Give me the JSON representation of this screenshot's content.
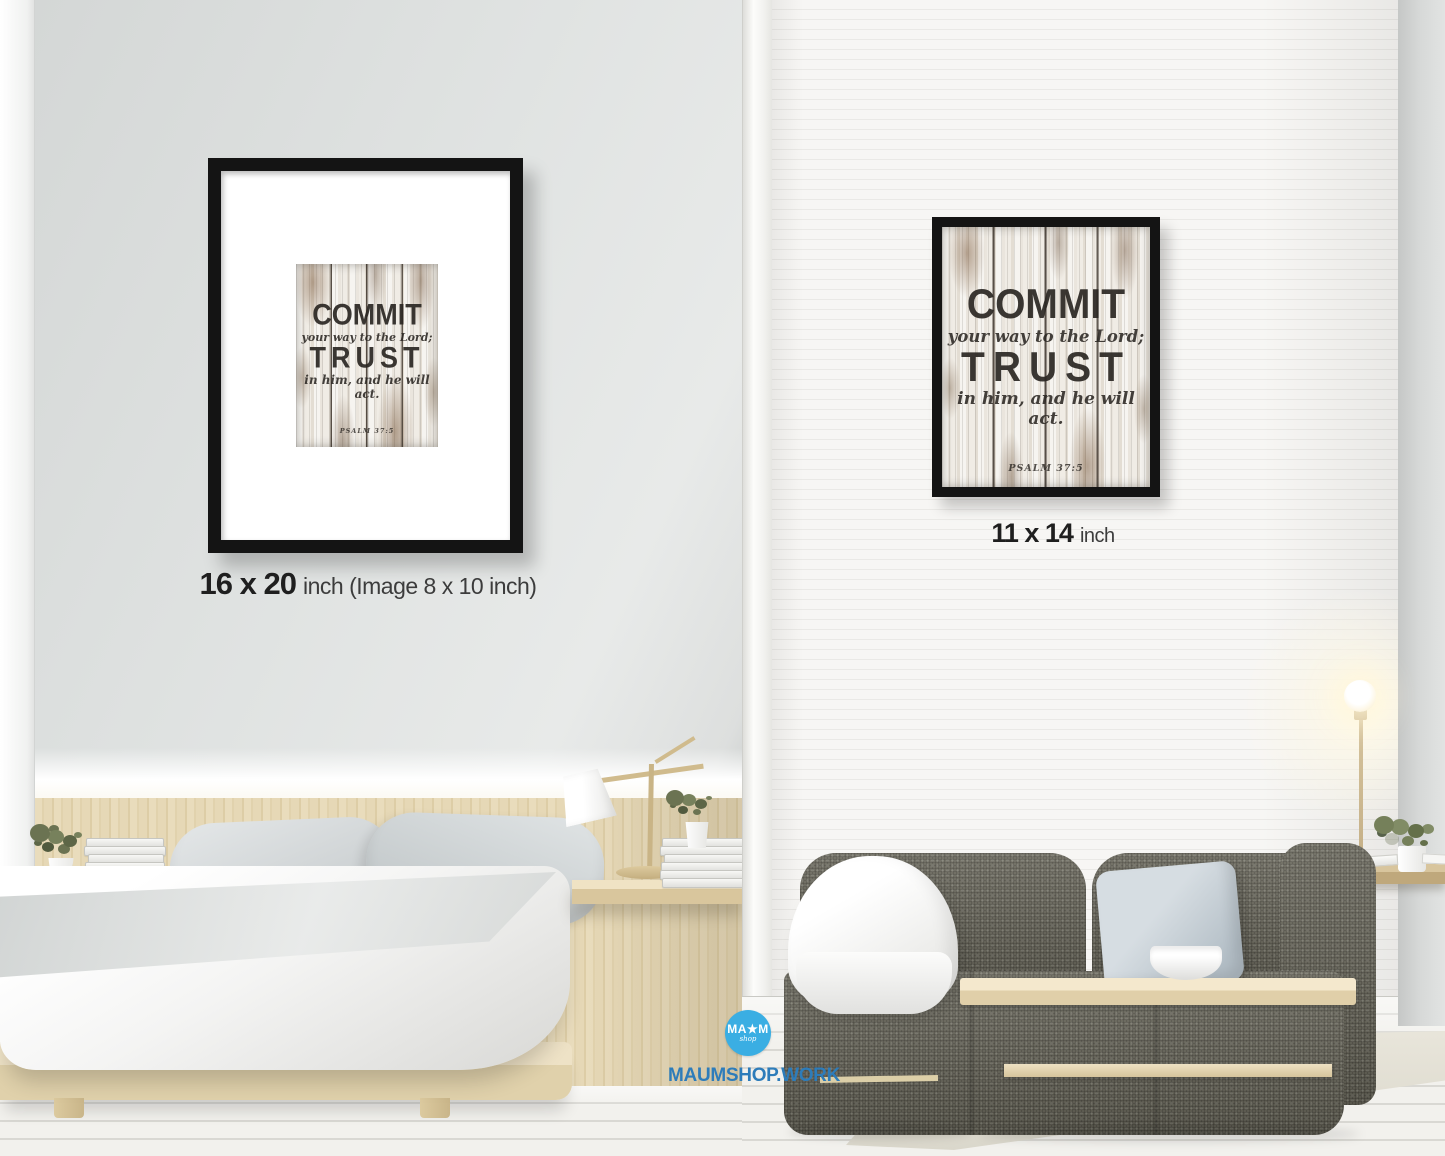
{
  "artwork": {
    "word1": "COMMIT",
    "phrase1": "your way to the Lord;",
    "word2": "TRUST",
    "phrase2": "in him, and he will act.",
    "reference": "PSALM 37:5"
  },
  "labels": {
    "left_size": "16 x 20",
    "left_size_suffix": "inch (Image 8 x 10 inch)",
    "right_size": "11 x 14",
    "right_size_suffix": "inch"
  },
  "branding": {
    "logo_top": "MA★M",
    "logo_script": "shop",
    "website": "MAUMSHOP.WORK",
    "logo_circle_color": "#3AAEE3",
    "website_color": "#2D7CBA"
  },
  "colors": {
    "frame": "#141414",
    "left_wall": "#dfe2e1",
    "right_wall": "#f5f4f2",
    "sofa_fabric": "#6d6b5f",
    "wood": "#e4d6b2"
  }
}
